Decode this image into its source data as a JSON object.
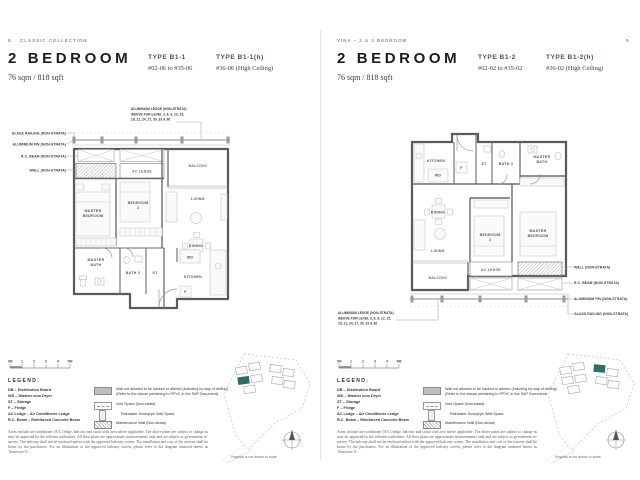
{
  "colors": {
    "keyplan_highlight": "#2f6e62",
    "type_heading_text": "#46555e",
    "title_text": "#1c1c1c"
  },
  "pages": {
    "left": {
      "page_number": "8",
      "running_head": "CLASSIC COLLECTION",
      "title": "2 BEDROOM",
      "area": "76 sqm / 818 sqft",
      "types": [
        {
          "name": "TYPE B1-1",
          "units": "#02-06 to #35-06"
        },
        {
          "name": "TYPE B1-1(h)",
          "units": "#36-06 (High Ceiling)"
        }
      ]
    },
    "right": {
      "page_number": "9",
      "running_head": "VINA – 2 & 3 BEDROOM",
      "title": "2 BEDROOM",
      "area": "76 sqm / 818 sqft",
      "types": [
        {
          "name": "TYPE B1-2",
          "units": "#02-02 to #35-02"
        },
        {
          "name": "TYPE B1-2(h)",
          "units": "#36-02 (High Ceiling)"
        }
      ]
    }
  },
  "plan_labels": {
    "master_bedroom_1": "MASTER",
    "master_bedroom_2": "BEDROOM",
    "bedroom2_1": "BEDROOM",
    "bedroom2_2": "2",
    "living": "LIVING",
    "dining": "DINING",
    "kitchen": "KITCHEN",
    "wd": "WD",
    "f": "F",
    "st": "ST",
    "bath2": "BATH 2",
    "master_bath_1": "MASTER",
    "master_bath_2": "BATH",
    "balcony": "BALCONY",
    "ac_ledge": "AC LEDGE",
    "callout_glass_railing": "GLASS RAILING (NON-STRATA)",
    "callout_aluminium_fin": "ALUMINIUM FIN (NON-STRATA)",
    "callout_rc_beam": "R.C. BEAM (NON-STRATA)",
    "callout_wall": "WALL (NON-STRATA)",
    "callout_ledge_1": "ALUMINIUM LEDGE (NON-STRATA)",
    "callout_ledge_2": "ABOVE FOR LEVEL 3, 6, 9, 12, 15,",
    "callout_ledge_3": "18, 21, 24, 27, 30, 33 & 36"
  },
  "scale_bar": {
    "labels": [
      "0M",
      "1",
      "2",
      "3",
      "4",
      "5M"
    ]
  },
  "legend": {
    "heading": "LEGEND:",
    "abbreviations": [
      "DB – Distribution Board",
      "WD – Washer cum Dryer",
      "ST – Storage",
      "F – Fridge",
      "AC Ledge – Air Conditioner Ledge",
      "R.C. Beam – Reinforced Concrete Beam"
    ],
    "symbols": [
      {
        "text": "Wall not allowed to be hacked or altered (including by way of drilling) (Refer to the clause pertaining to PPVC in the S&P Document)"
      },
      {
        "text": "Void Space (Non-strata)"
      },
      {
        "text": "Rainwater Downpipe Wall Space"
      },
      {
        "text": "Maintenance Wall (Non-strata)"
      }
    ]
  },
  "disclaimer": "Areas include air-conditioner (A/C) ledge, balcony and strata void area where applicable. The above plans are subject to change as may be approved by the relevant authorities. All floor plans are approximate measurements only and are subject to government re-survey. The balcony shall not be enclosed unless with the approved balcony screen. The installation and cost of the screens shall be borne by the purchasers. For an illustration of the approved balcony screen, please refer to the diagram annexed hereto as 'Annexure A'.",
  "keyplan": {
    "caption": "Keyplan is not drawn to scale"
  }
}
